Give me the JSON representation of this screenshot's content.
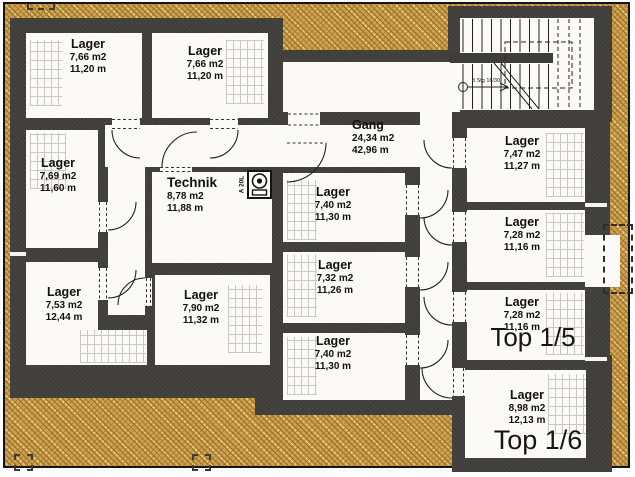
{
  "plan": {
    "title": "Kellergeschoss Lagerplan",
    "rooms": [
      {
        "id": "tl1",
        "name": "Lager",
        "area": "7,66 m2",
        "perimeter": "11,20 m"
      },
      {
        "id": "tl2",
        "name": "Lager",
        "area": "7,66 m2",
        "perimeter": "11,20 m"
      },
      {
        "id": "l1",
        "name": "Lager",
        "area": "7,69 m2",
        "perimeter": "11,60 m"
      },
      {
        "id": "l2",
        "name": "Lager",
        "area": "7,53 m2",
        "perimeter": "12,44 m"
      },
      {
        "id": "technik",
        "name": "Technik",
        "area": "8,78 m2",
        "perimeter": "11,88 m"
      },
      {
        "id": "m_bl",
        "name": "Lager",
        "area": "7,90 m2",
        "perimeter": "11,32 m"
      },
      {
        "id": "m1",
        "name": "Lager",
        "area": "7,40 m2",
        "perimeter": "11,30 m"
      },
      {
        "id": "m2",
        "name": "Lager",
        "area": "7,32 m2",
        "perimeter": "11,26 m"
      },
      {
        "id": "m3",
        "name": "Lager",
        "area": "7,40 m2",
        "perimeter": "11,30 m"
      },
      {
        "id": "gang",
        "name": "Gang",
        "area": "24,34 m2",
        "perimeter": "42,96 m"
      },
      {
        "id": "r1",
        "name": "Lager",
        "area": "7,47 m2",
        "perimeter": "11,27 m"
      },
      {
        "id": "r2",
        "name": "Lager",
        "area": "7,28 m2",
        "perimeter": "11,16 m"
      },
      {
        "id": "r3",
        "name": "Lager",
        "area": "7,28 m2",
        "perimeter": "11,16 m"
      },
      {
        "id": "r4",
        "name": "Lager",
        "area": "8,98 m2",
        "perimeter": "12,13 m"
      }
    ],
    "units": [
      {
        "id": "top15",
        "label": "Top 1/5"
      },
      {
        "id": "top16",
        "label": "Top 1/6"
      }
    ],
    "annotations": {
      "stair_note": "8 Stg 16/30",
      "boiler_label": "A 20L"
    },
    "colors": {
      "ground_hatch": "#d3a24f",
      "wall": "#3f3d39",
      "room_fill": "#fbfaf6",
      "text": "#111111"
    }
  }
}
